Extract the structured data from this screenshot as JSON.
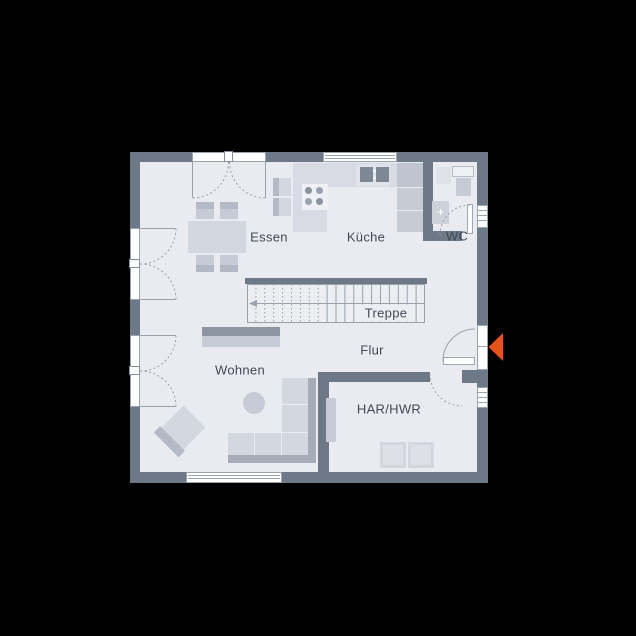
{
  "title": "Erdgeschoss Grundriss",
  "rooms": [
    {
      "id": "essen",
      "label": "Essen"
    },
    {
      "id": "kueche",
      "label": "Küche"
    },
    {
      "id": "wc",
      "label": "WC"
    },
    {
      "id": "treppe",
      "label": "Treppe"
    },
    {
      "id": "flur",
      "label": "Flur"
    },
    {
      "id": "wohnen",
      "label": "Wohnen"
    },
    {
      "id": "har",
      "label": "HAR/HWR"
    }
  ],
  "icons": {
    "entrance_marker": "left-pointing-triangle"
  },
  "colors": {
    "background": "#000000",
    "wall": "#6e7987",
    "floor": "#e9ebf0",
    "stair_floor": "#eceef2",
    "line": "#9aa2ae",
    "furniture": "#d3d7e0",
    "furniture_mid": "#c6cbd5",
    "furniture_dark": "#a6adb9",
    "band": "#b3b9c5",
    "appliance_dark": "#7e8794",
    "frame_white": "#ffffff",
    "accent": "#e5521b",
    "text": "#424956"
  }
}
